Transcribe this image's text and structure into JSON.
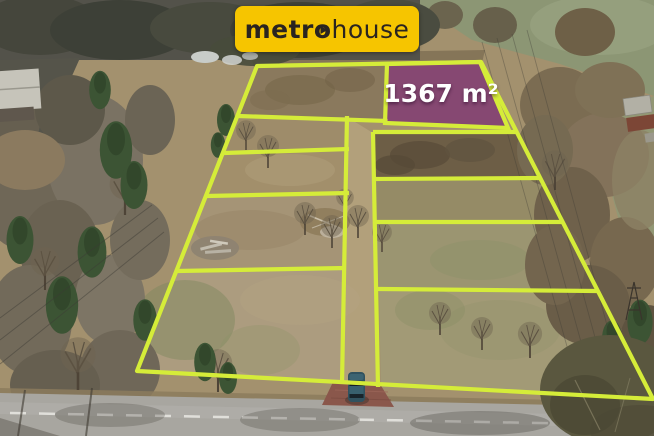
{
  "brand_banner": {
    "logo_prefix": "metr",
    "logo_o": "o",
    "logo_suffix": "house",
    "background_color": "#f6c500",
    "text_color": "#2a2420"
  },
  "highlighted_plot": {
    "area_label": "1367 m²",
    "fill_color": "#8f2b8b",
    "fill_opacity": "0.55",
    "label_color": "#ffffff"
  },
  "plot_overlay": {
    "line_color": "#d5ec39"
  },
  "scene": {
    "road_marking_color": "#e9e8e3",
    "car_color": "#31525f",
    "driveway_color": "#8a574b"
  }
}
